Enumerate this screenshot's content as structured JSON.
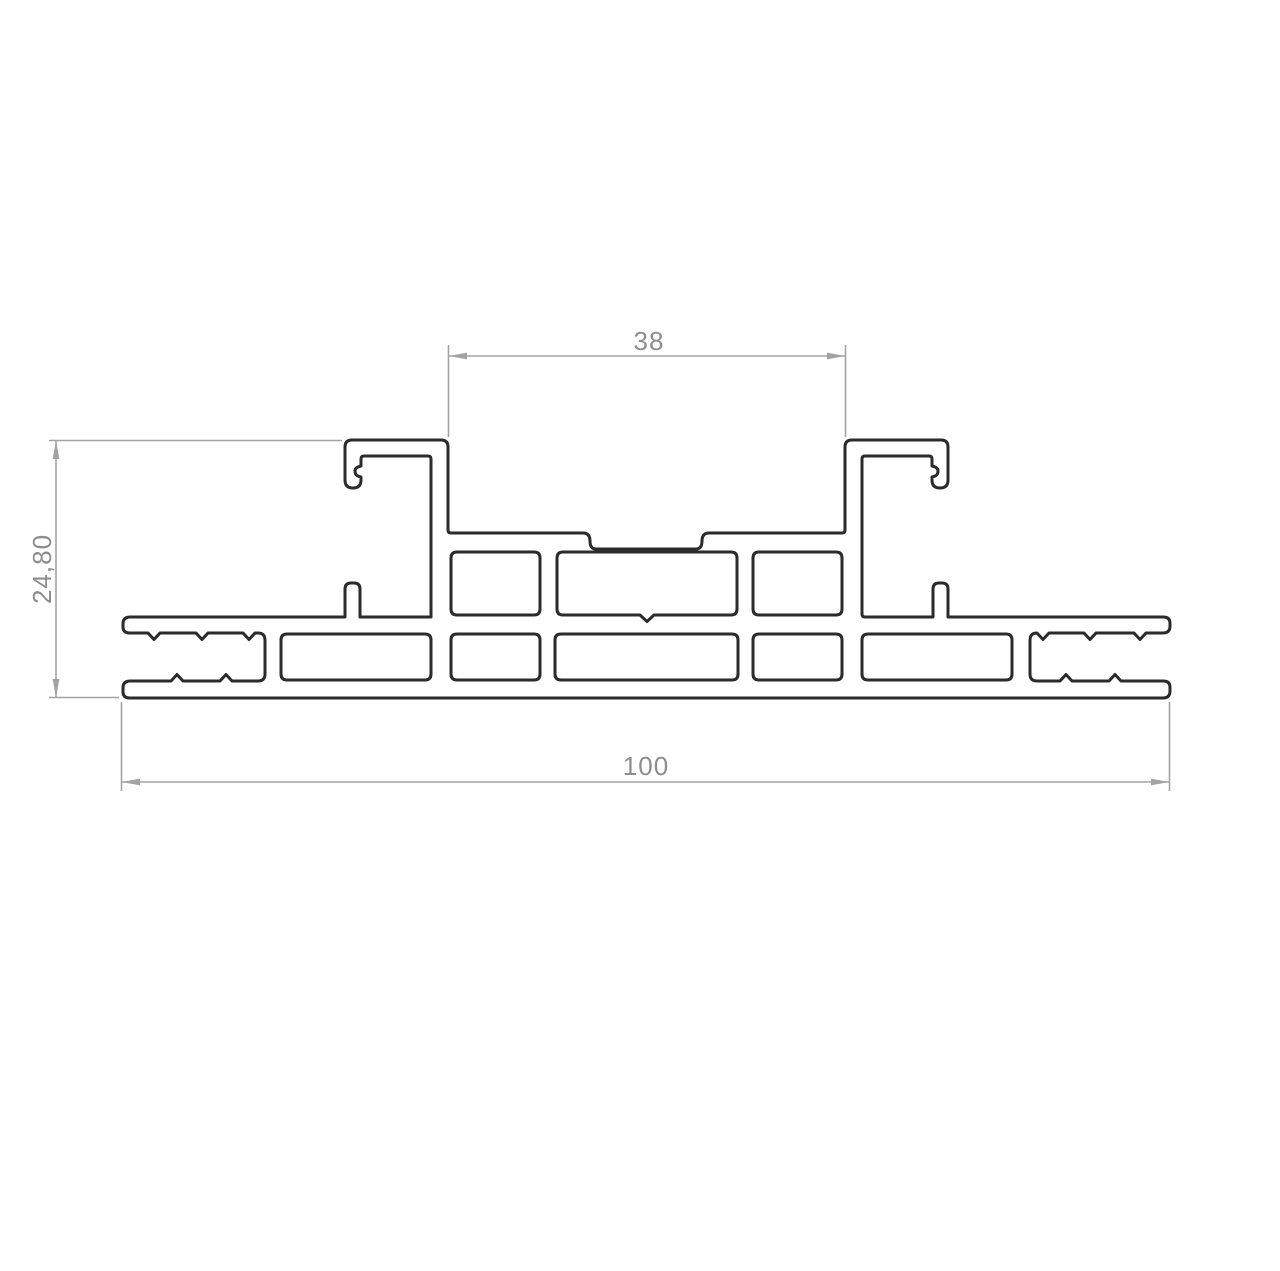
{
  "app": {
    "title": "Aluminium extrusion profile cross-section drawing",
    "background": "#ffffff"
  },
  "drawing": {
    "type": "technical-cad-cross-section",
    "subject": "symmetric aluminium extrusion profile with two clip posts, two rows of internal cavities and open serrated screw slots at both ends",
    "profile_stroke_color": "#2b2b2b",
    "dim_line_color": "#a3a3a3",
    "dim_text_color": "#8d8d8d",
    "dimensions": {
      "top_gap": {
        "label": "38",
        "orientation": "horizontal",
        "measures": "clear distance between the two top posts (mm)"
      },
      "height": {
        "label": "24,80",
        "orientation": "vertical",
        "measures": "overall profile height (mm)"
      },
      "overall_width": {
        "label": "100",
        "orientation": "horizontal",
        "measures": "overall profile width (mm)"
      }
    }
  }
}
